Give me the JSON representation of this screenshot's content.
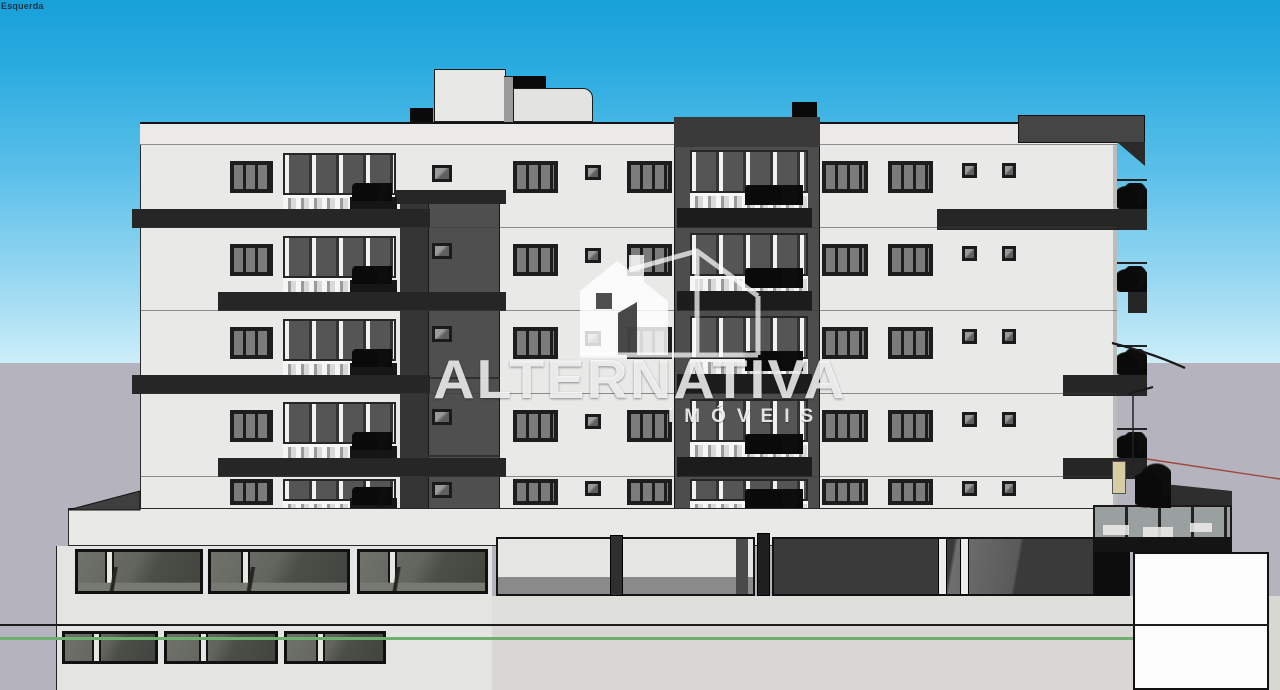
{
  "scene_tab": {
    "label": "Esquerda"
  },
  "watermark": {
    "brand": "ALTERNATIVA",
    "subtitle": "IMÓVEIS",
    "icon": "house-logo-icon"
  },
  "building": {
    "type": "apartment-elevation-render",
    "floors": 5,
    "has_tower": true,
    "has_ground_garage": true
  },
  "palette": {
    "sky_top": "#17a0d9",
    "sky_horizon": "#cdeef9",
    "ground_back": "#b5b4be",
    "ground_front": "#d8d7d3",
    "facade": "#e9e9e7",
    "parapet": "#eceae8",
    "slab_band": "#262626",
    "tower": "#4d4d4d",
    "tower_top": "#3a3a3a",
    "shaft": "#4f4f4f",
    "shaft_cap": "#262626",
    "planter": "#161616",
    "roof_box_white": "#e8e8e6",
    "roof_box_black": "#0a0a0a",
    "roof_box_gray": "#454545",
    "white_board": "#fcfcfc",
    "green_line": "#6fae6f",
    "red_line": "#a04840",
    "wire_line": "#1a1a1a",
    "tan_wall": "#d6cda5",
    "scene_tab_text": "#1c3347"
  }
}
